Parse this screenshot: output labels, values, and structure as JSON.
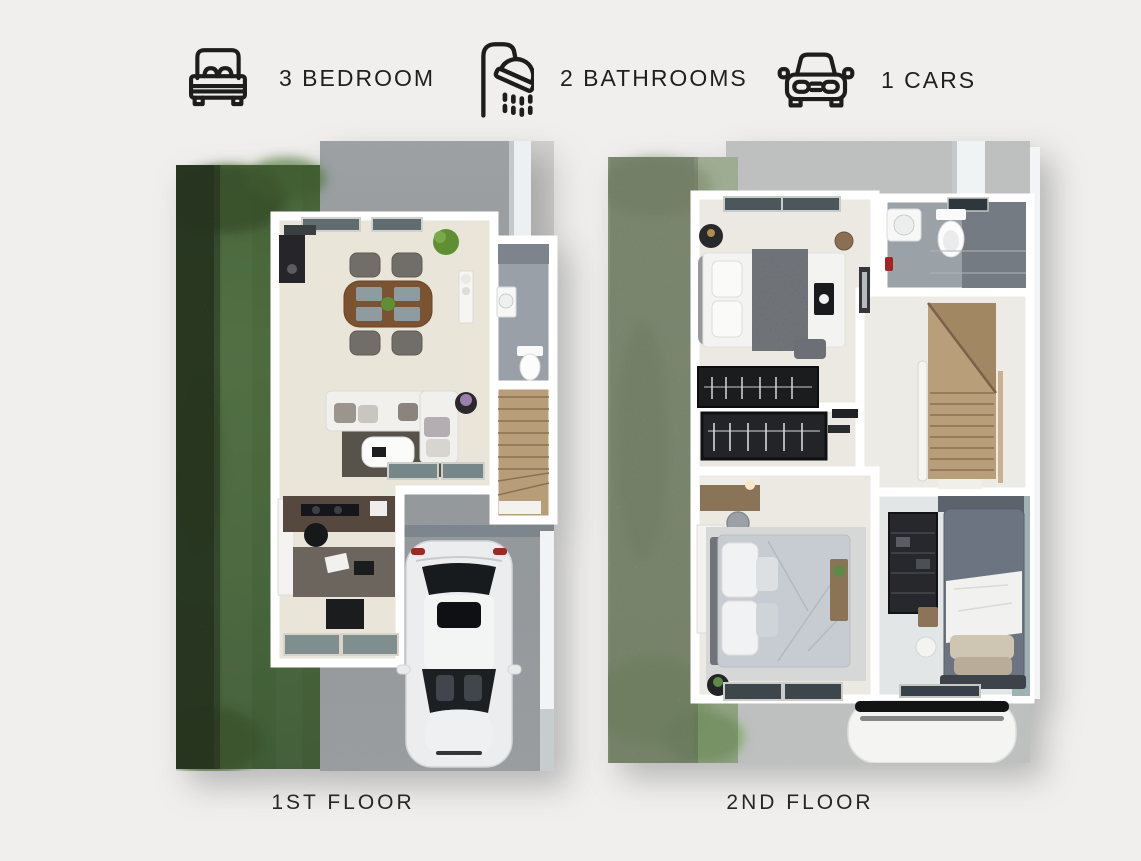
{
  "page": {
    "background_color": "#f0efed",
    "text_color": "#1f1f1f"
  },
  "header": {
    "features": [
      {
        "icon": "bed-icon",
        "label": "3 BEDROOM"
      },
      {
        "icon": "shower-icon",
        "label": "2 BATHROOMS"
      },
      {
        "icon": "car-icon",
        "label": "1 CARS"
      }
    ]
  },
  "floor_plans": [
    {
      "caption": "1ST FLOOR",
      "rooms": [
        "living-dining-room",
        "bathroom",
        "staircase",
        "kitchen-study",
        "garage"
      ],
      "features": [
        "lawn",
        "hedge",
        "driveway",
        "parked-car",
        "dining-table-with-4-chairs",
        "sofa",
        "coffee-table",
        "rug",
        "tv-console",
        "kitchen-counter",
        "desk",
        "toilet",
        "washbasin"
      ]
    },
    {
      "caption": "2ND FLOOR",
      "rooms": [
        "bedroom-2",
        "bathroom",
        "stair-hall",
        "wardrobe-hall",
        "master-bedroom",
        "bedroom-3"
      ],
      "features": [
        "lawn",
        "hedge",
        "double-bed",
        "single-bed",
        "wardrobes",
        "clothes-rack",
        "vanity-desk",
        "staircase",
        "toilet",
        "washbasin",
        "car-roof"
      ]
    }
  ],
  "colors": {
    "lawn_dark_green": "#54813e",
    "hedge_green": "#31501f",
    "lawn_pale_green": "#b6cba4",
    "driveway_concrete": "#a3a8ab",
    "concrete_light": "#c8cac9",
    "wall_white": "#ffffff",
    "floor_beige": "#eae5d9",
    "bathroom_tile_gray": "#99a0a6",
    "stair_wood": "#b89e78",
    "car_white": "#ecedee"
  }
}
